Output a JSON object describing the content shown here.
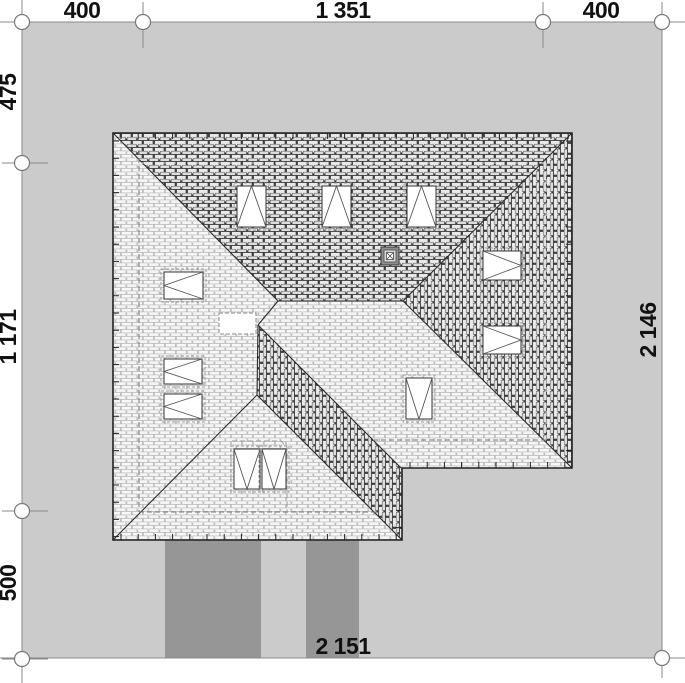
{
  "drawing": {
    "kind_label": "",
    "dimensions": {
      "top": [
        "400",
        "1 351",
        "400"
      ],
      "left": [
        "475",
        "1 171",
        "500"
      ],
      "right": [
        "2 146"
      ],
      "bottom": [
        "2 151"
      ]
    }
  },
  "colors": {
    "page_bg": "#ffffff",
    "plot_fill": "#cbcbcb",
    "driveway_fill": "#969696",
    "dim_line": "#8a8a8a",
    "dim_text": "#111111",
    "roof_line": "#2b2b2b",
    "roof_light_mortar": "#a8a8a8",
    "roof_dark_mortar": "#3c3c3c",
    "skylight_fill": "#ffffff"
  }
}
